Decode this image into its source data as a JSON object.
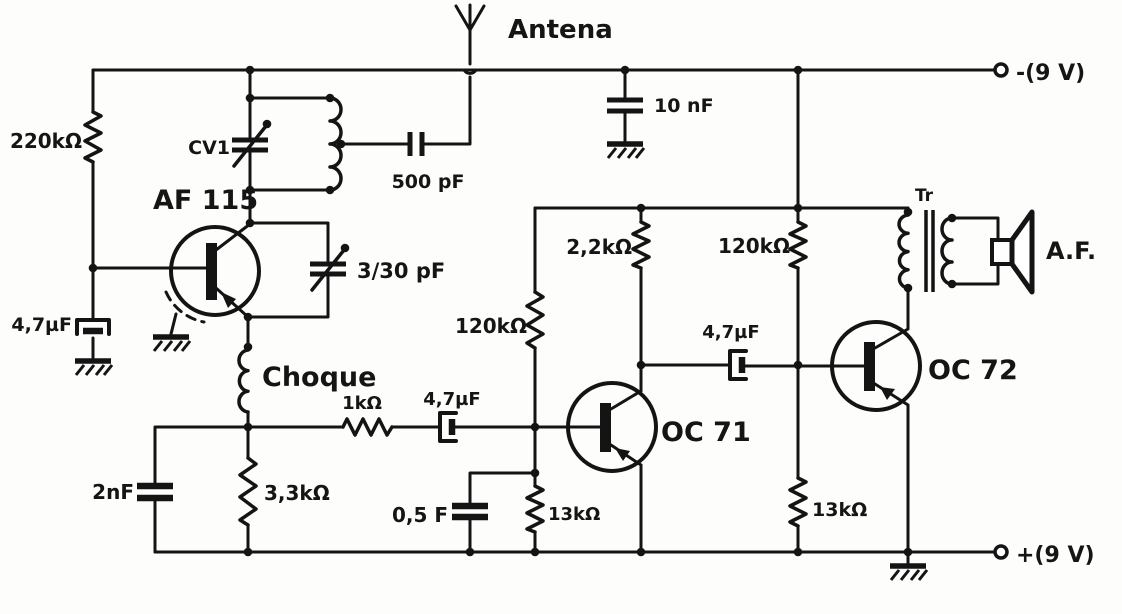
{
  "labels": {
    "antenna": "Antena",
    "supply_neg": "-(9 V)",
    "supply_pos": "+(9 V)",
    "r220k": "220kΩ",
    "cv1": "CV1",
    "af115": "AF 115",
    "c500pf": "500 pF",
    "c10nf": "10 nF",
    "trimmer": "3/30 pF",
    "c47uf_base": "4,7µF",
    "choke": "Choque",
    "r1k": "1kΩ",
    "c47uf_in": "4,7µF",
    "c2nf": "2nF",
    "r3k3": "3,3kΩ",
    "c05f": "0,5 F",
    "r13k_left": "13kΩ",
    "r120k_left": "120kΩ",
    "r2k2": "2,2kΩ",
    "r120k_right": "120kΩ",
    "c47uf_out": "4,7µF",
    "oc71": "OC 71",
    "oc72": "OC 72",
    "r13k_right": "13kΩ",
    "transformer": "Tr",
    "speaker": "A.F."
  }
}
